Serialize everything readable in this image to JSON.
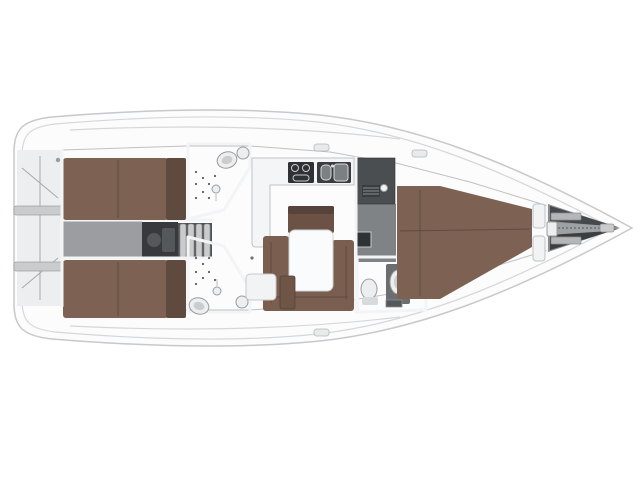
{
  "plan": {
    "kind": "sailing-yacht-interior-layout-top-view",
    "orientation": "bow-right-stern-left"
  },
  "colors": {
    "background": "#ffffff",
    "hull": "#fcfcfd",
    "hull_outline": "#c6c8ca",
    "floor": "#d2d4d6",
    "transom": "#eceef0",
    "ledge": "#c9cbcd",
    "corridor_aft": "#9b9da0",
    "engine": "#37393c",
    "engine_part": "#55585b",
    "step": "#c9cbcd",
    "step_gap": "#505356",
    "bed": "#7d6253",
    "bed_shadow": "#5f4a40",
    "sofa": "#7a5e4f",
    "sofa_back": "#6b5245",
    "sofa_back_top": "#57433a",
    "stool": "#6e5546",
    "table": "#fafbfc",
    "counter": "#f4f5f6",
    "stove": "#2f3134",
    "sink_unit": "#3a3c3f",
    "sink_basin": "#7d8083",
    "locker_dark": "#4b4e51",
    "locker_grille": "#3a3d40",
    "head_floor": "#3a3d40",
    "head_floor_fwd": "#45484b",
    "fixture_white": "#eceeef",
    "fixture_inner": "#caccce",
    "console_gray": "#6b6e71",
    "corridor_fwd": "#808386",
    "seat_dark": "#303336",
    "anchor_base": "#8b8e90",
    "anchor_dark_top": "#46494c",
    "anchor_dark_bottom": "#3c3f42",
    "anchor_channel": "#9ea1a3",
    "crossbar": "#b4b6b8",
    "windlass": "#eceef0",
    "bow_fitting": "#c9cbcd",
    "hatch": "#e8eaec",
    "pillar": "#f2f3f4",
    "cabinet_white": "#f2f3f4"
  },
  "rooms": [
    {
      "id": "swim-platform",
      "label": "stern swim platform / lazarette"
    },
    {
      "id": "aft-cabin-port",
      "label": "aft double cabin (port)"
    },
    {
      "id": "aft-cabin-starboard",
      "label": "aft double cabin (starboard)"
    },
    {
      "id": "aft-head-port",
      "label": "aft head with shower (port)"
    },
    {
      "id": "aft-head-starboard",
      "label": "aft head with shower (starboard)"
    },
    {
      "id": "engine-companionway",
      "label": "engine compartment and companionway steps"
    },
    {
      "id": "galley",
      "label": "L-shaped galley with stove and twin sinks"
    },
    {
      "id": "salon-dinette",
      "label": "salon with U-sofa and table"
    },
    {
      "id": "forward-corridor",
      "label": "lockers and corridor"
    },
    {
      "id": "forward-head",
      "label": "forward head"
    },
    {
      "id": "forward-cabin",
      "label": "forward owner cabin with double berth"
    },
    {
      "id": "anchor-locker",
      "label": "bow anchor locker with windlass"
    }
  ]
}
